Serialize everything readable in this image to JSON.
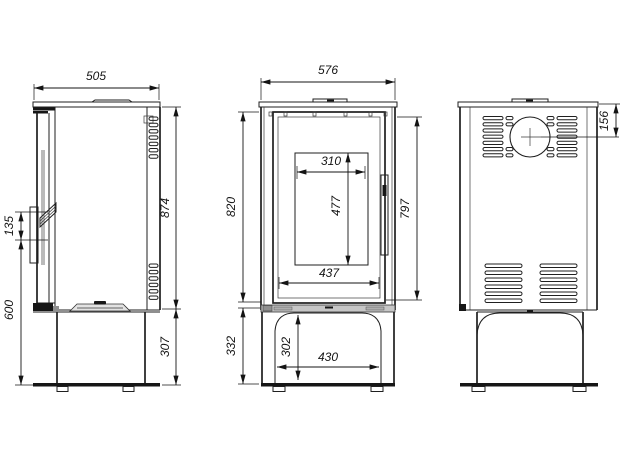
{
  "style": {
    "ink": "#1f1f1f",
    "background": "#ffffff",
    "plinth_gray": "#c6c6c6"
  },
  "views": {
    "side": {
      "dims": {
        "depth": "505",
        "body_height": "874",
        "base_height": "307",
        "handle_span": "135",
        "handle_height_from_floor": "600"
      }
    },
    "front": {
      "dims": {
        "width": "576",
        "body_height_left": "820",
        "door_height": "797",
        "glass_width": "310",
        "glass_height": "477",
        "door_width": "437",
        "base_height": "332",
        "base_opening_height": "302",
        "base_opening_width": "430"
      }
    },
    "back": {
      "dims": {
        "flue_center_from_top": "156"
      }
    }
  }
}
